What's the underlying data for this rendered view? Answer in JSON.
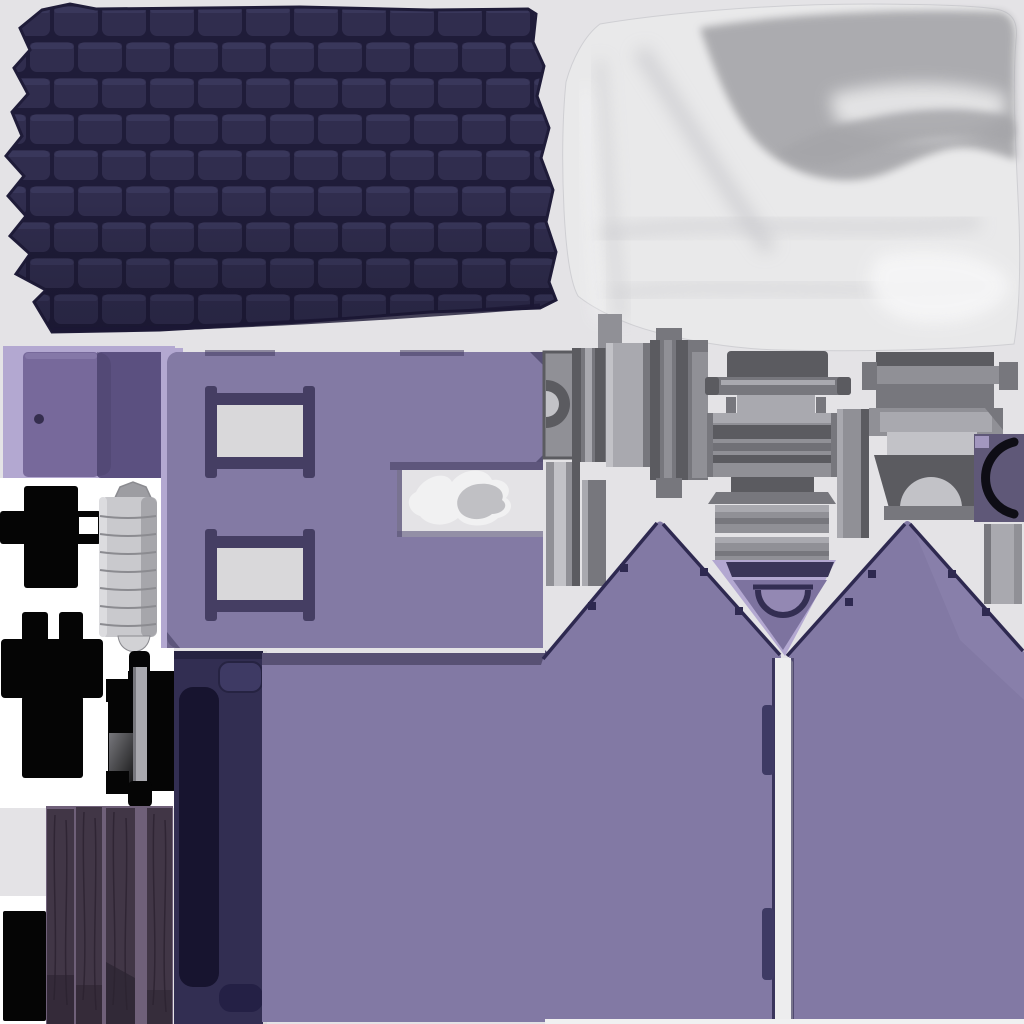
{
  "meta": {
    "kind": "baked 3D texture atlas of a toy house model",
    "canvas": {
      "width": 1024,
      "height": 1024
    }
  },
  "palette": {
    "bg": "#e4e3e6",
    "white": "#ffffff",
    "roof_tile": "#302d4e",
    "roof_tile_hi": "#45426b",
    "roof_gap": "#1f1c39",
    "roof_edge": "#1b1834",
    "fabric_base": "#e9e9ea",
    "fabric_shadow": "#a5a5a9",
    "fabric_mid": "#c9c9cd",
    "fabric_hi": "#f7f7f8",
    "lavender": "#b3a8d1",
    "door_purple": "#77699b",
    "door_dark": "#5b5080",
    "knob": "#352e4e",
    "wall_purple": "#837aa4",
    "wall_shadow": "#5e567c",
    "frame_dark": "#453e63",
    "window_hole": "#d9d8da",
    "cloth_white": "#f1f1f2",
    "cloth_gray": "#b4b4b8",
    "black": "#050505",
    "cyl_body": "#c9c9cd",
    "cyl_hi": "#dcdcdf",
    "cyl_shade": "#9d9da2",
    "cyl_line": "#8b8b90",
    "grey_1": "#5b5b60",
    "grey_2": "#77777d",
    "grey_3": "#909096",
    "grey_4": "#a9a9af",
    "grey_5": "#c2c2c7",
    "navy_panel": "#322e52",
    "navy_dark": "#17142f",
    "navy_mid": "#3e3a64",
    "navy_bump": "#242045",
    "navy_edge": "#262342",
    "wood_bg": "#6f6079",
    "wood_plank": "#413646",
    "wood_grain": "#2d2331",
    "wood_shadow": "#2b2330",
    "gable_purple": "#8279a4",
    "gable_light": "#9c92bc",
    "gable_inner": "#7d739f",
    "gable_edge": "#2e2950",
    "vbar": "#3a3558",
    "arch_stroke": "#332e52",
    "gap_white": "#ededee",
    "band_dark": "#585174",
    "archbox": "#5f5878",
    "arch_black": "#0e0d15",
    "strip_light": "#d9d9db"
  },
  "regions": {
    "background": {
      "label": "flat light grey atlas background",
      "color": "bg"
    },
    "roof_shingles": {
      "label": "dark navy shingle tile sheet, offset brick layout, jagged left edge",
      "bbox": [
        6,
        2,
        550,
        332
      ],
      "tile_size": [
        44,
        30
      ],
      "colors": [
        "roof_tile",
        "roof_gap"
      ]
    },
    "satin_curtain": {
      "label": "white satin cloth bake with grey folds, darker upper-right",
      "bbox": [
        562,
        2,
        458,
        350
      ],
      "colors": [
        "fabric_base",
        "fabric_shadow"
      ]
    },
    "door_piece": {
      "label": "door leaf with knob plus dark open-door panel on lavender backing",
      "bbox": [
        3,
        346,
        172,
        132
      ],
      "knob_position": [
        39,
        419
      ]
    },
    "windowed_wall": {
      "label": "purple wall with two framed window cutouts and right-edge notch",
      "bbox": [
        161,
        346,
        384,
        302
      ],
      "windows": 2
    },
    "crumpled_cloth": {
      "label": "small crumpled white cloth inside wall notch",
      "bbox": [
        405,
        482,
        112,
        46
      ]
    },
    "hardware_parts": {
      "label": "grey bench / mantel / fireplace hardware pieces",
      "bbox": [
        540,
        310,
        484,
        300
      ],
      "pieces": [
        "capstan-notch-block",
        "banded-pillar-left",
        "banded-pillar-right",
        "side-planks",
        "bench-assembly",
        "slat-stack",
        "middle-plank",
        "mantel-shelf",
        "stepped-frame",
        "fireplace-arch",
        "arched-corner-block",
        "edge-plank"
      ]
    },
    "black_brackets": {
      "label": "solid black bracket silhouettes",
      "items": [
        [
          0,
          486,
          101,
          102
        ],
        [
          1,
          612,
          102,
          166
        ],
        [
          106,
          651,
          68,
          156
        ],
        [
          3,
          911,
          43,
          110
        ]
      ]
    },
    "cylinder_stack": {
      "label": "stacked grey cylinder segments with domed caps",
      "bbox": [
        99,
        482,
        58,
        170
      ],
      "segments": 8
    },
    "navy_door_panel": {
      "label": "tall navy panel with recessed dark slot and rounded inserts",
      "bbox": [
        174,
        651,
        92,
        373
      ]
    },
    "wood_planks": {
      "label": "four dark wood planks on mauve backing",
      "bbox": [
        46,
        806,
        127,
        218
      ],
      "planks": 4
    },
    "gable_walls": {
      "label": "two purple gable walls joined, lavender V porch notch, white door gap",
      "bbox": [
        262,
        518,
        762,
        506
      ],
      "peaks": [
        [
          660,
          522
        ],
        [
          907,
          522
        ]
      ],
      "v_apex": [
        783,
        658
      ]
    },
    "porch_arch": {
      "label": "dark arched detail inside the V notch",
      "bbox": [
        726,
        560,
        110,
        95
      ]
    },
    "door_gap": {
      "label": "white vertical seam between gable walls with two navy hinge tabs",
      "bbox": [
        772,
        658,
        22,
        366
      ]
    }
  }
}
